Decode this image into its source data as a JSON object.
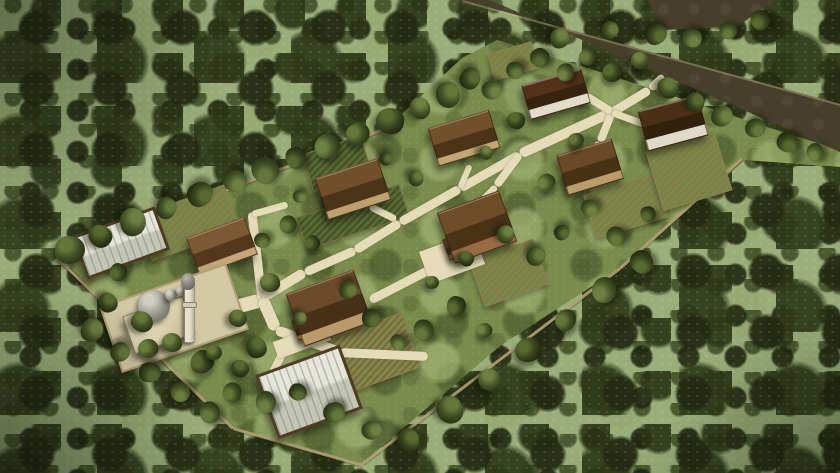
{
  "scene": {
    "description": "Aerial 3D architectural render of a small village in dense woodland: eight brown-roofed houses, a mosque with grey dome and minaret, two white-roofed greenhouses, vineyard plots, cream footpaths, perimeter walls and a dark road cutting through the forest at the top right",
    "palette": {
      "forest_base": "#9db37f",
      "grass_base": "#7a8f4f",
      "grass_light": "#a4b877",
      "grass_dark": "#516432",
      "road": "#443d2b",
      "road_curb": "#cdc39b",
      "path": "#ece4c2",
      "wall_line": "#b5a47a",
      "mosque_wall": "#e3dab8",
      "mosque_side": "#c7ba92",
      "dome": "#9a9b92",
      "dome_light": "#d6d6cf",
      "minaret_body": "#efe9d8",
      "minaret_cap": "#6a6a61",
      "greenhouse_light": "#edeee6",
      "greenhouse_mid": "#c9cec0",
      "frame": "#4c3b24",
      "tree_hi": "#64793b",
      "tree_mid": "#3e4e23",
      "tree_dark": "#232e13",
      "shadow": "rgba(12,16,6,0.5)"
    },
    "clearing_polygon": [
      [
        58,
        255
      ],
      [
        388,
        127
      ],
      [
        462,
        58
      ],
      [
        497,
        40
      ],
      [
        600,
        72
      ],
      [
        700,
        105
      ],
      [
        770,
        128
      ],
      [
        840,
        150
      ],
      [
        840,
        167
      ],
      [
        745,
        160
      ],
      [
        620,
        268
      ],
      [
        500,
        346
      ],
      [
        360,
        465
      ],
      [
        300,
        448
      ],
      [
        233,
        428
      ],
      [
        120,
        318
      ]
    ],
    "road": {
      "main_polygon": [
        [
          462,
          0
        ],
        [
          840,
          104
        ],
        [
          840,
          152
        ],
        [
          490,
          0
        ]
      ],
      "branch_polygon": [
        [
          648,
          0
        ],
        [
          775,
          0
        ],
        [
          738,
          26
        ],
        [
          664,
          30
        ]
      ],
      "curb": [
        462,
        1,
        840,
        105,
        2
      ]
    },
    "walls": [
      [
        58,
        255,
        388,
        127
      ],
      [
        58,
        258,
        233,
        428
      ],
      [
        233,
        428,
        363,
        465
      ],
      [
        363,
        463,
        620,
        268
      ],
      [
        620,
        268,
        742,
        158
      ]
    ],
    "fields": [
      {
        "name": "vineyard-west",
        "x": 187,
        "y": 222,
        "w": 92,
        "h": 46,
        "rot": -20,
        "tone": "green"
      },
      {
        "name": "vineyard-south",
        "x": 368,
        "y": 354,
        "w": 88,
        "h": 56,
        "rot": -20,
        "tone": "tan"
      },
      {
        "name": "vineyard-below-east-house",
        "x": 508,
        "y": 272,
        "w": 66,
        "h": 46,
        "rot": -20,
        "tone": "green"
      },
      {
        "name": "vineyard-mid-east",
        "x": 625,
        "y": 205,
        "w": 74,
        "h": 44,
        "rot": -17,
        "tone": "green"
      },
      {
        "name": "vineyard-northeast",
        "x": 688,
        "y": 170,
        "w": 70,
        "h": 60,
        "rot": -17,
        "tone": "green"
      },
      {
        "name": "crop-plot-north",
        "x": 336,
        "y": 163,
        "w": 60,
        "h": 38,
        "rot": -18,
        "tone": "dark"
      },
      {
        "name": "crop-plot-center-north",
        "x": 352,
        "y": 216,
        "w": 106,
        "h": 32,
        "rot": -18,
        "tone": "dark"
      },
      {
        "name": "crop-plot-road",
        "x": 512,
        "y": 60,
        "w": 44,
        "h": 26,
        "rot": -16,
        "tone": "green"
      }
    ],
    "paths": {
      "segments": [
        [
          205,
          315,
          262,
          300,
          14
        ],
        [
          262,
          300,
          252,
          212,
          9
        ],
        [
          252,
          214,
          288,
          204,
          7
        ],
        [
          262,
          298,
          305,
          272,
          10
        ],
        [
          305,
          272,
          355,
          250,
          9
        ],
        [
          355,
          250,
          400,
          222,
          9
        ],
        [
          400,
          222,
          460,
          188,
          9
        ],
        [
          460,
          188,
          520,
          154,
          9
        ],
        [
          520,
          154,
          612,
          112,
          10
        ],
        [
          612,
          112,
          650,
          89,
          9
        ],
        [
          650,
          89,
          664,
          76,
          8
        ],
        [
          612,
          112,
          600,
          142,
          8
        ],
        [
          600,
          142,
          584,
          160,
          7
        ],
        [
          612,
          112,
          586,
          96,
          8
        ],
        [
          612,
          112,
          656,
          128,
          7
        ],
        [
          370,
          206,
          396,
          219,
          7
        ],
        [
          520,
          154,
          496,
          186,
          8
        ],
        [
          496,
          186,
          452,
          232,
          7
        ],
        [
          262,
          298,
          276,
          330,
          12
        ],
        [
          276,
          330,
          340,
          352,
          10
        ],
        [
          340,
          352,
          428,
          356,
          9
        ],
        [
          288,
          342,
          272,
          374,
          8
        ],
        [
          370,
          300,
          432,
          268,
          9
        ],
        [
          460,
          188,
          470,
          165,
          6
        ]
      ],
      "pads": [
        {
          "name": "terrace-east-house",
          "x": 452,
          "y": 258,
          "w": 58,
          "h": 34,
          "rot": -20
        },
        {
          "name": "plaza-south",
          "x": 302,
          "y": 341,
          "w": 56,
          "h": 18,
          "rot": -20
        }
      ]
    },
    "buildings": [
      {
        "name": "house-west",
        "x": 221,
        "y": 245,
        "w": 60,
        "h": 38,
        "rot": -20,
        "roof_light": "#7c5a34",
        "roof_dark": "#52361d",
        "wall": "#c9ab7e",
        "wall_frac": 0.82
      },
      {
        "name": "house-northwest",
        "x": 352,
        "y": 188,
        "w": 64,
        "h": 42,
        "rot": -18,
        "roof_light": "#6f4f2b",
        "roof_dark": "#4a3118",
        "wall": "#c4a476",
        "wall_frac": 0.82,
        "wing": [
          -16,
          11,
          28,
          18
        ]
      },
      {
        "name": "house-center",
        "x": 328,
        "y": 307,
        "w": 70,
        "h": 54,
        "rot": -20,
        "roof_light": "#6b4a2a",
        "roof_dark": "#452e18",
        "wall": "#bf9e6e",
        "wall_frac": 0.8,
        "wing": [
          -19,
          17,
          30,
          20
        ]
      },
      {
        "name": "house-north1",
        "x": 463,
        "y": 137,
        "w": 62,
        "h": 38,
        "rot": -17,
        "roof_light": "#70502c",
        "roof_dark": "#4b3219",
        "wall": "#c8aa7a",
        "wall_frac": 0.82
      },
      {
        "name": "house-north2",
        "x": 555,
        "y": 93,
        "w": 60,
        "h": 34,
        "rot": -16,
        "roof_light": "#503019,",
        "roof_dark": "#33200e",
        "wall": "#e9e4d6",
        "wall_frac": 0.74
      },
      {
        "name": "house-northeast",
        "x": 672,
        "y": 122,
        "w": 60,
        "h": 40,
        "rot": -15,
        "roof_light": "#472d15",
        "roof_dark": "#2e1d0c",
        "wall": "#e7e2d4",
        "wall_frac": 0.74
      },
      {
        "name": "house-east",
        "x": 476,
        "y": 226,
        "w": 64,
        "h": 52,
        "rot": -20,
        "roof_light": "#6d4c28",
        "roof_dark": "#473016",
        "wall": "#9c6b49",
        "wall_frac": 0.78,
        "wing": [
          -17,
          18,
          28,
          20
        ]
      },
      {
        "name": "house-southeast-mid",
        "x": 589,
        "y": 166,
        "w": 56,
        "h": 40,
        "rot": -17,
        "roof_light": "#6a4827",
        "roof_dark": "#463016",
        "wall": "#c2a070",
        "wall_frac": 0.8,
        "wing": [
          -14,
          11,
          22,
          16
        ]
      }
    ],
    "greenhouses": [
      {
        "name": "greenhouse-west",
        "x": 118,
        "y": 240,
        "w": 82,
        "h": 40,
        "rot": -20
      },
      {
        "name": "greenhouse-south",
        "x": 306,
        "y": 389,
        "w": 84,
        "h": 62,
        "rot": -20
      }
    ],
    "mosque": {
      "courtyard": {
        "x": 172,
        "y": 316,
        "w": 130,
        "h": 66,
        "rot": -19
      },
      "hall": {
        "x": 158,
        "y": 324,
        "w": 62,
        "h": 38,
        "rot": -19
      },
      "dome": {
        "cx": 154,
        "cy": 306,
        "r": 16
      },
      "small_domes": [
        {
          "cx": 171,
          "cy": 295,
          "r": 6
        },
        {
          "cx": 181,
          "cy": 291,
          "r": 5
        }
      ],
      "minaret": {
        "x": 184,
        "y": 281,
        "w": 9,
        "h": 60,
        "balcony_y": 302,
        "cap_cx": 188,
        "cap_cy": 281,
        "cap_r": 7
      }
    },
    "trees": [
      [
        70,
        250,
        15
      ],
      [
        100,
        236,
        12
      ],
      [
        133,
        222,
        14
      ],
      [
        166,
        208,
        11
      ],
      [
        200,
        194,
        13
      ],
      [
        235,
        181,
        12
      ],
      [
        265,
        170,
        14
      ],
      [
        296,
        158,
        11
      ],
      [
        327,
        146,
        13
      ],
      [
        358,
        134,
        12
      ],
      [
        390,
        121,
        14
      ],
      [
        420,
        108,
        11
      ],
      [
        448,
        95,
        13
      ],
      [
        470,
        78,
        11
      ],
      [
        492,
        90,
        10
      ],
      [
        515,
        70,
        9
      ],
      [
        540,
        58,
        10
      ],
      [
        565,
        72,
        9
      ],
      [
        588,
        56,
        9
      ],
      [
        612,
        72,
        10
      ],
      [
        640,
        60,
        9
      ],
      [
        668,
        88,
        11
      ],
      [
        695,
        102,
        10
      ],
      [
        722,
        116,
        11
      ],
      [
        755,
        128,
        10
      ],
      [
        788,
        142,
        11
      ],
      [
        815,
        152,
        9
      ],
      [
        288,
        224,
        9
      ],
      [
        312,
        243,
        8
      ],
      [
        270,
        282,
        10
      ],
      [
        238,
        318,
        9
      ],
      [
        256,
        347,
        11
      ],
      [
        300,
        318,
        7
      ],
      [
        348,
        290,
        9
      ],
      [
        372,
        318,
        10
      ],
      [
        398,
        342,
        8
      ],
      [
        424,
        330,
        11
      ],
      [
        456,
        306,
        10
      ],
      [
        484,
        330,
        8
      ],
      [
        432,
        282,
        7
      ],
      [
        466,
        258,
        8
      ],
      [
        506,
        234,
        9
      ],
      [
        536,
        256,
        10
      ],
      [
        562,
        232,
        8
      ],
      [
        590,
        208,
        9
      ],
      [
        616,
        236,
        10
      ],
      [
        648,
        214,
        8
      ],
      [
        546,
        182,
        9
      ],
      [
        576,
        140,
        8
      ],
      [
        516,
        120,
        9
      ],
      [
        486,
        152,
        7
      ],
      [
        416,
        178,
        8
      ],
      [
        386,
        158,
        7
      ],
      [
        300,
        196,
        7
      ],
      [
        262,
        240,
        8
      ],
      [
        642,
        262,
        12
      ],
      [
        604,
        290,
        13
      ],
      [
        566,
        320,
        11
      ],
      [
        528,
        350,
        13
      ],
      [
        490,
        380,
        12
      ],
      [
        450,
        410,
        14
      ],
      [
        408,
        440,
        12
      ],
      [
        372,
        430,
        10
      ],
      [
        334,
        412,
        11
      ],
      [
        298,
        392,
        9
      ],
      [
        266,
        402,
        11
      ],
      [
        232,
        392,
        10
      ],
      [
        202,
        362,
        12
      ],
      [
        172,
        342,
        10
      ],
      [
        142,
        322,
        11
      ],
      [
        108,
        302,
        10
      ],
      [
        92,
        330,
        12
      ],
      [
        120,
        352,
        10
      ],
      [
        150,
        372,
        11
      ],
      [
        180,
        392,
        10
      ],
      [
        210,
        412,
        11
      ],
      [
        118,
        272,
        9
      ],
      [
        148,
        348,
        10
      ],
      [
        214,
        352,
        8
      ],
      [
        240,
        368,
        9
      ],
      [
        560,
        38,
        10
      ],
      [
        610,
        30,
        9
      ],
      [
        656,
        34,
        11
      ],
      [
        692,
        38,
        10
      ],
      [
        728,
        30,
        9
      ],
      [
        760,
        20,
        10
      ]
    ]
  }
}
